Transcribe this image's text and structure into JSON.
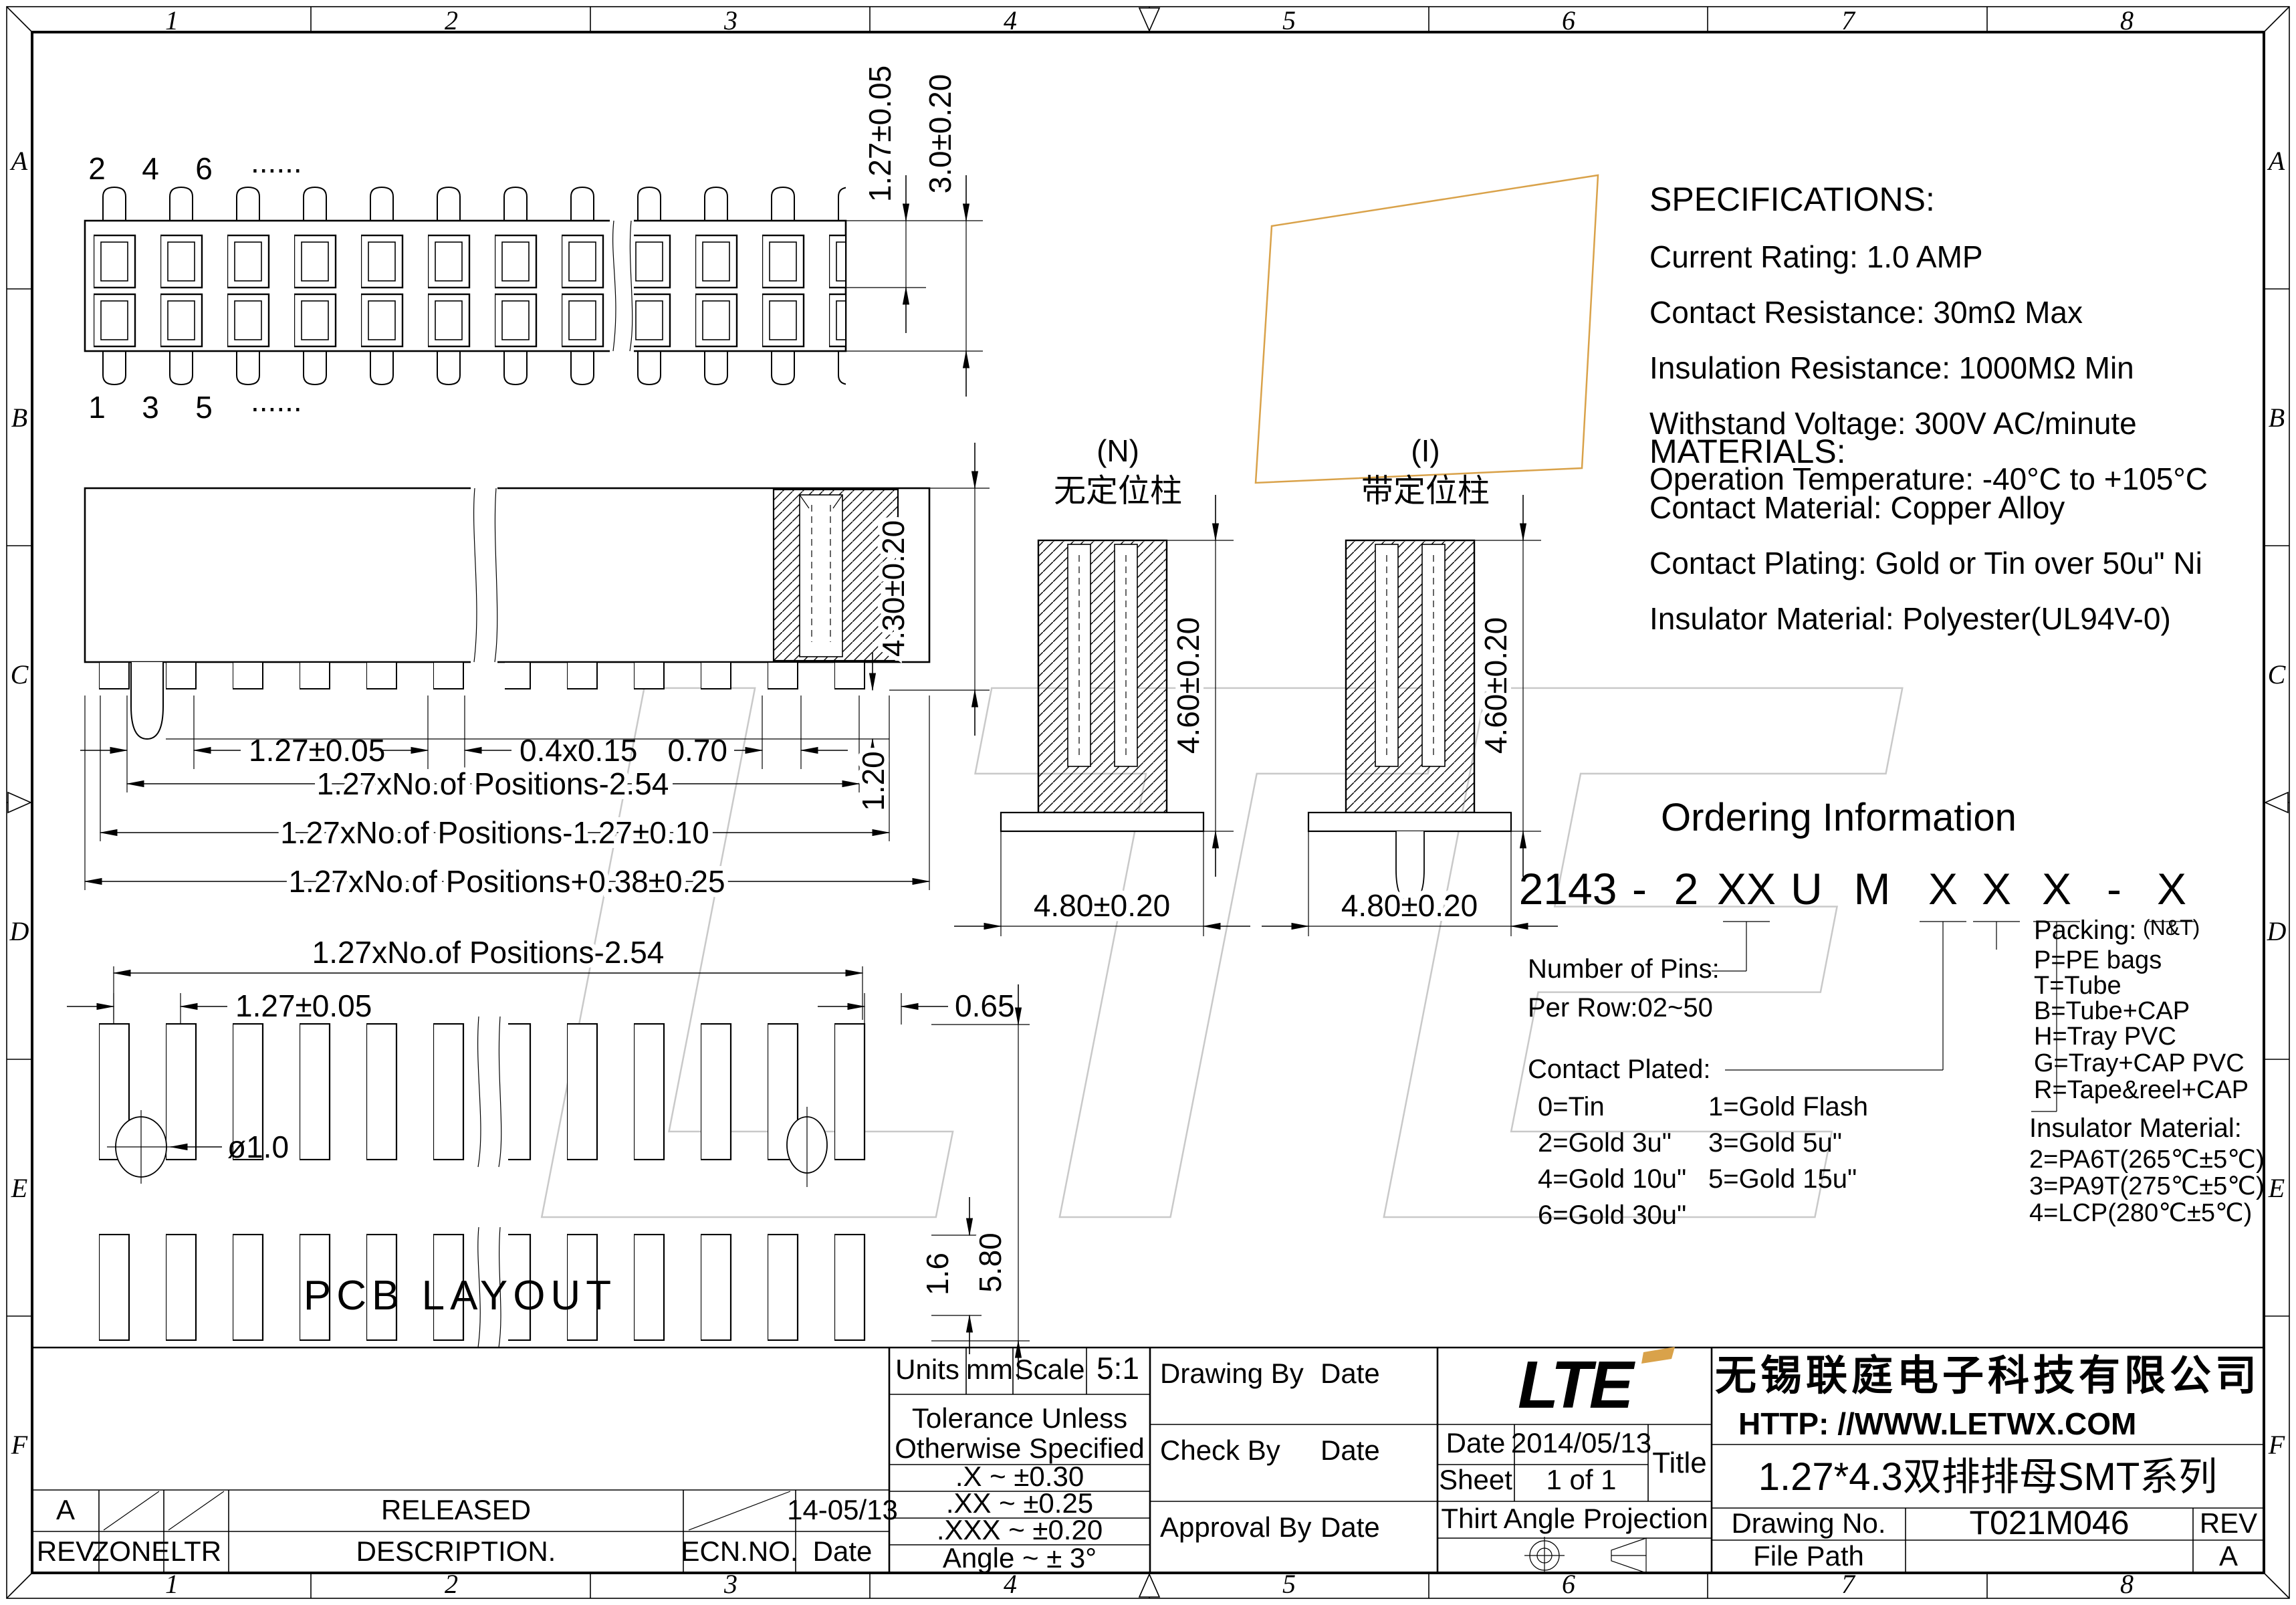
{
  "zones": {
    "cols": [
      "1",
      "2",
      "3",
      "4",
      "5",
      "6",
      "7",
      "8"
    ],
    "rows": [
      "A",
      "B",
      "C",
      "D",
      "E",
      "F"
    ]
  },
  "top_view": {
    "pin_top_1": "2",
    "pin_top_2": "4",
    "pin_top_3": "6",
    "pin_top_dots": "......",
    "pin_bot_1": "1",
    "pin_bot_2": "3",
    "pin_bot_3": "5",
    "pin_bot_dots": "......",
    "dim_pitch": "1.27±0.05",
    "dim_width": "3.0±0.20"
  },
  "front_view": {
    "dim_pitch": "1.27±0.05",
    "dim_pad": "0.4x0.15",
    "dim_gap": "0.70",
    "dim_leg": "1.20",
    "dim_height": "4.30±0.20",
    "dim_chain1": "1.27xNo.of Positions-2.54",
    "dim_chain2": "1.27xNo.of Positions-1.27±0.10",
    "dim_chain3": "1.27xNo.of Positions+0.38±0.25"
  },
  "sections": {
    "n_tag": "(N)",
    "n_label": "无定位柱",
    "i_tag": "(I)",
    "i_label": "带定位柱",
    "dim_height": "4.60±0.20",
    "dim_width": "4.80±0.20"
  },
  "pcb": {
    "dim_chain": "1.27xNo.of Positions-2.54",
    "dim_pitch": "1.27±0.05",
    "dim_gap": "0.65",
    "dim_hole": "ø1.0",
    "dim_pad_h": "1.6",
    "dim_total_h": "5.80",
    "caption": "PCB LAYOUT"
  },
  "specifications": {
    "heading": "SPECIFICATIONS:",
    "items": [
      "Current Rating: 1.0 AMP",
      "Contact Resistance: 30mΩ Max",
      "Insulation Resistance: 1000MΩ Min",
      "Withstand Voltage: 300V AC/minute",
      "Operation Temperature: -40°C to +105°C"
    ]
  },
  "materials": {
    "heading": "MATERIALS:",
    "items": [
      "Contact Material: Copper Alloy",
      "Contact Plating: Gold or Tin over 50u\" Ni",
      "Insulator Material: Polyester(UL94V-0)"
    ]
  },
  "ordering": {
    "heading": "Ordering Information",
    "part_number": [
      "2143",
      "-",
      "2",
      "XX",
      "U",
      "M",
      "X",
      "X",
      "X",
      "-",
      "X"
    ],
    "pins_label": "Number of Pins:",
    "pins_range": "Per Row:02~50",
    "plating_label": "Contact  Plated:",
    "plating": [
      [
        "0=Tin",
        "1=Gold Flash"
      ],
      [
        "2=Gold  3u\"",
        "3=Gold  5u\""
      ],
      [
        "4=Gold 10u\"",
        "5=Gold 15u\""
      ],
      [
        "6=Gold  30u\"",
        ""
      ]
    ],
    "packing_label": "Packing:",
    "packing_note": "(N&T)",
    "packing": [
      "P=PE bags",
      "T=Tube",
      "B=Tube+CAP",
      "H=Tray PVC",
      "G=Tray+CAP PVC",
      "R=Tape&reel+CAP"
    ],
    "insulator_label": "Insulator Material:",
    "insulator": [
      "2=PA6T(265℃±5℃)",
      "3=PA9T(275℃±5℃)",
      "4=LCP(280℃±5℃)"
    ]
  },
  "title_block": {
    "units_label": "Units",
    "units_value": "mm",
    "scale_label": "Scale",
    "scale_value": "5:1",
    "tol_line1": "Tolerance Unless",
    "tol_line2": "Otherwise Specified",
    "tol_rows": [
      ".X  ~  ±0.30",
      ".XX  ~  ±0.25",
      ".XXX  ~  ±0.20",
      "Angle  ~  ± 3°"
    ],
    "drawing_by": "Drawing By",
    "check_by": "Check  By",
    "approval_by": "Approval By",
    "date_label": "Date",
    "date_value": "2014/05/13",
    "sheet_label": "Sheet",
    "sheet_value": "1 of 1",
    "title_label": "Title",
    "projection_label": "Thirt Angle Projection",
    "logo": "LTE",
    "company": "无锡联庭电子科技有限公司",
    "website": "HTTP: //WWW.LETWX.COM",
    "title_value": "1.27*4.3双排排母SMT系列",
    "drawing_no_label": "Drawing No.",
    "drawing_no_value": "T021M046",
    "rev_label": "REV",
    "rev_value": "A",
    "file_path_label": "File Path"
  },
  "revision": {
    "rev": "A",
    "description": "RELEASED",
    "date": "14-05/13",
    "headers": [
      "REV",
      "ZONE",
      "LTR",
      "DESCRIPTION.",
      "ECN.NO.",
      "Date"
    ]
  },
  "colors": {
    "line": "#000000",
    "watermark": "#c9c9c9",
    "accent": "#d9a24a"
  }
}
